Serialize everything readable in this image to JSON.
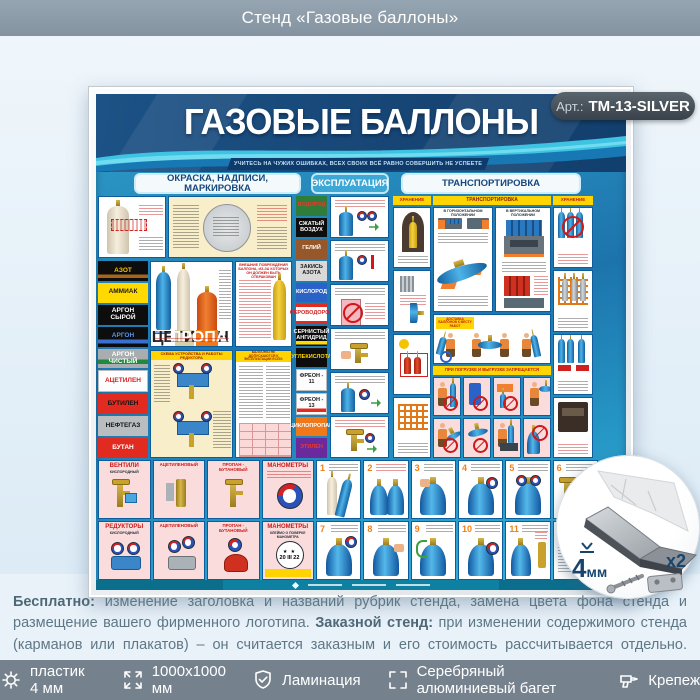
{
  "header": {
    "title": "Стенд «Газовые баллоны»"
  },
  "badge": {
    "prefix": "Арт.:",
    "code": "ТМ-13-SILVER"
  },
  "stand": {
    "title": "ГАЗОВЫЕ БАЛЛОНЫ",
    "motto": "УЧИТЕСЬ НА ЧУЖИХ ОШИБКАХ, ВСЕХ СВОИХ ВСЁ РАВНО СОВЕРШИТЬ НЕ УСПЕЕТЕ",
    "tabs": [
      {
        "label": "ОКРАСКА, НАДПИСИ, МАРКИРОВКА"
      },
      {
        "label": "ЭКСПЛУАТАЦИЯ"
      },
      {
        "label": "ТРАНСПОРТИРОВКА"
      }
    ],
    "gas_labels_left": [
      {
        "text": "АЗОТ",
        "style": "background:linear-gradient(180deg,#0d0d0d 0 68%,#a86418 68% 86%,#0d0d0d 86%);color:#f5c400"
      },
      {
        "text": "АММИАК",
        "style": "background:#ffd900;color:#1a1a1a"
      },
      {
        "text": "АРГОН СЫРОЙ",
        "style": "background:#0d0d0d;color:#fff"
      },
      {
        "text": "АРГОН",
        "style": "background:linear-gradient(180deg,#0d0d0d 0 62%,#3a6fd0 62% 82%,#0d0d0d 82%);color:#5a92ea"
      },
      {
        "text": "АРГОН ЧИСТЫЙ",
        "style": "background:linear-gradient(180deg,#a9adb0 0 55%,#1f8a3c 55% 80%,#a9adb0 80%);color:#fff"
      },
      {
        "text": "АЦЕТИЛЕН",
        "style": "background:#fdfdfd;color:#d42222;border:1px solid #b9bdc0"
      },
      {
        "text": "БУТИЛЕН",
        "style": "background:#e22b20;color:#141414"
      },
      {
        "text": "НЕФТЕГАЗ",
        "style": "background:#b9bdc0;color:#141414"
      },
      {
        "text": "БУТАН",
        "style": "background:#e22b20;color:#fff"
      }
    ],
    "gas_labels_mid": [
      {
        "text": "ВОДОРОД",
        "style": "background:#2e7d3a;color:#e83a2a"
      },
      {
        "text": "СЖАТЫЙ ВОЗДУХ",
        "style": "background:#0d0d0d;color:#fff"
      },
      {
        "text": "ГЕЛИЙ",
        "style": "background:#96572a;color:#fff"
      },
      {
        "text": "ЗАКИСЬ АЗОТА",
        "style": "background:#d9d9d9;color:#1a1a1a"
      },
      {
        "text": "КИСЛОРОД",
        "style": "background:#2a62c8;color:#fff"
      },
      {
        "text": "СЕРОВОДОРОД",
        "style": "background:linear-gradient(180deg,#e22b20 0 14%,#fff 14% 86%,#e22b20 86%);color:#d42222"
      },
      {
        "text": "СЕРНИСТЫЙ АНГИДРИД",
        "style": "background:linear-gradient(180deg,#0d0d0d 0 76%,#ffd900 76% 92%,#0d0d0d 92%);color:#fff"
      },
      {
        "text": "УГЛЕКИСЛОТА",
        "style": "background:#0d0d0d;color:#ffd900"
      },
      {
        "text": "ФРЕОН - 11",
        "style": "background:#fdfdfd;color:#1a1a1a;border:1px solid #b9bdc0"
      },
      {
        "text": "ФРЕОН - 13",
        "style": "background:linear-gradient(180deg,#fdfdfd 0 72%,#e22b20 72% 90%,#fdfdfd 90%);color:#1a1a1a;border:1px solid #b9bdc0"
      },
      {
        "text": "ЦИКЛОПРОПАН",
        "style": "background:#f07818;color:#fff"
      },
      {
        "text": "ЭТИЛЕН",
        "style": "background:#6a2a9e;color:#e83a2a"
      }
    ],
    "cylinder_tags": [
      {
        "text": "КИСЛОРОД",
        "style": "background:#2a62c8;color:#fff"
      },
      {
        "text": "АЦЕТИЛЕН",
        "style": "background:#d8cfa8;color:#222"
      },
      {
        "text": "ПРОПАН-БУТАН",
        "style": "background:#f07818;color:#fff"
      }
    ],
    "sections": {
      "reducer_scheme_title": "СХЕМА УСТРОЙСТВА И РАБОТЫ РЕДУКТОРА",
      "damage_title": "ВНЕШНИЕ ПОВРЕЖДЕНИЯ БАЛЛОНА, ИЗ-ЗА КОТОРЫХ ОН ДОЛЖЕН БЫТЬ ОТБРАКОВАН",
      "not_allowed_title": "БАЛЛОНЫ НЕ ДОПУСКАЮТСЯ К ЭКСПЛУАТАЦИИ ЕСЛИ:",
      "storage_left_title": "ХРАНЕНИЕ",
      "storage_right_title": "ХРАНЕНИЕ",
      "transport_title": "ТРАНСПОРТИРОВКА",
      "horizontal_title": "В ГОРИЗОНТАЛЬНОМ ПОЛОЖЕНИИ",
      "vertical_title": "В ВЕРТИКАЛЬНОМ ПОЛОЖЕНИИ",
      "delivery_title": "ДОСТАВКА БАЛЛОНОВ К МЕСТУ РАБОТ",
      "loading_ban_title": "ПРИ ПОГРУЗКЕ И ВЫГРУЗКЕ ЗАПРЕЩАЕТСЯ"
    },
    "bottom_panels": {
      "row1": [
        {
          "title": "ВЕНТИЛИ",
          "sub": "КИСЛОРОДНЫЙ"
        },
        {
          "title": "АЦЕТИЛЕНОВЫЙ",
          "sub": ""
        },
        {
          "title": "ПРОПАН - БУТАНОВЫЙ",
          "sub": ""
        },
        {
          "title": "МАНОМЕТРЫ",
          "sub": ""
        }
      ],
      "row2": [
        {
          "title": "РЕДУКТОРЫ",
          "sub": "КИСЛОРОДНЫЙ"
        },
        {
          "title": "АЦЕТИЛЕНОВЫЙ",
          "sub": ""
        },
        {
          "title": "ПРОПАН - БУТАНОВЫЙ",
          "sub": ""
        },
        {
          "title": "МАНОМЕТРЫ",
          "sub": "КЛЕЙМО О ПОВЕРКЕ МАНОМЕТРА",
          "stamp": "20 III 22"
        }
      ]
    },
    "steps": [
      "1",
      "2",
      "3",
      "4",
      "5",
      "6",
      "7",
      "8",
      "9",
      "10",
      "11",
      "12"
    ]
  },
  "inset": {
    "thickness_label": "4мм",
    "count_label": "x2"
  },
  "description": {
    "p1_bold": "Бесплатно:",
    "p1_text": " изменение заголовка и названий рубрик стенда, замена цвета фона стенда и размещение вашего фирменного логотипа. ",
    "p2_bold": "Заказной стенд:",
    "p2_text": " при изменении содержимого стенда (карманов или плакатов) – он считается заказным и его стоимость рассчитывается отдельно. ",
    "p3_bold": "Стенды на заказ:",
    "p3_text": " любые размер, комплектация, дизайн и оформление. На все изготовленные стенды даем 2 года гарантии. Выгодно, эстетично и надежно!"
  },
  "footer_bar": {
    "items": [
      {
        "icon": "gear-icon",
        "label": "пластик 4 мм"
      },
      {
        "icon": "dimensions-icon",
        "label": "1000x1000 мм"
      },
      {
        "icon": "lamination-shield-icon",
        "label": "Ламинация"
      },
      {
        "icon": "frame-corners-icon",
        "label": "Серебряный алюминиевый багет"
      },
      {
        "icon": "fastener-drill-icon",
        "label": "Крепеж"
      }
    ]
  },
  "colors": {
    "poster_teal": "#2a9cc9",
    "poster_navy": "#174676",
    "accent_yellow": "#ffd400",
    "header_gray": "#8b9aa7",
    "bar_gray": "#75828e",
    "badge_dark": "#454e56",
    "tab_text_blue": "#16487c",
    "frame_silver": "#e8eaec"
  }
}
